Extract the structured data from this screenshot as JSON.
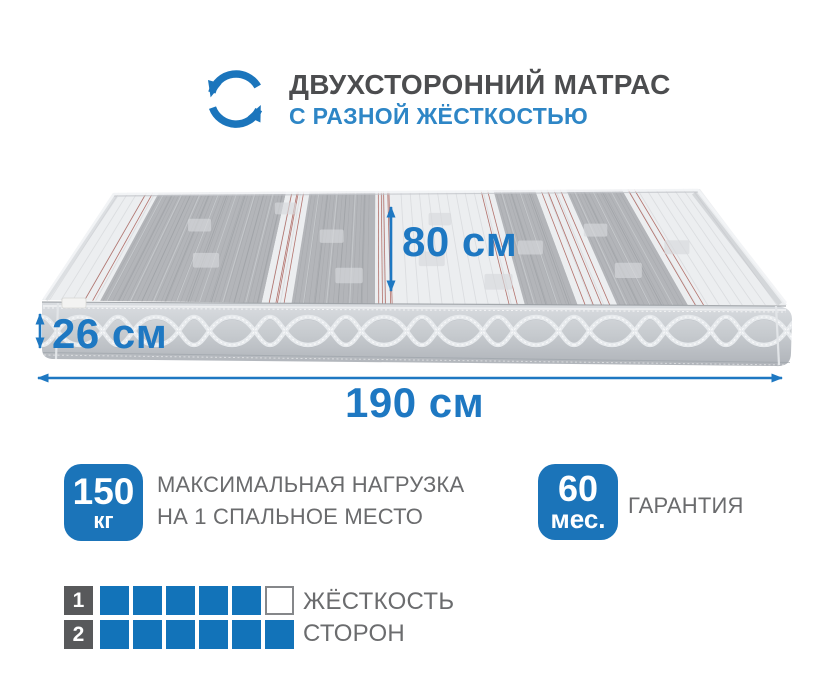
{
  "header": {
    "icon": "rotate-arrows-icon",
    "title": "ДВУХСТОРОННИЙ МАТРАС",
    "subtitle": "С РАЗНОЙ ЖЁСТКОСТЬЮ"
  },
  "dimensions": {
    "depth": "80 см",
    "height": "26 см",
    "length": "190 см"
  },
  "badges": [
    {
      "value": "150",
      "unit": "кг",
      "label_line1": "МАКСИМАЛЬНАЯ НАГРУЗКА",
      "label_line2": "НА 1 СПАЛЬНОЕ МЕСТО"
    },
    {
      "value": "60",
      "unit": "мес.",
      "label_line1": "ГАРАНТИЯ"
    }
  ],
  "firmness": {
    "label_line1": "ЖЁСТКОСТЬ",
    "label_line2": "СТОРОН",
    "scale_max": 6,
    "rows": [
      {
        "number": "1",
        "filled": 5
      },
      {
        "number": "2",
        "filled": 6
      }
    ]
  },
  "colors": {
    "primary_blue": "#1b74b9",
    "square_blue": "#1273b9",
    "arrow_blue": "#1e78c2",
    "subtitle_blue": "#2e86c6",
    "title_gray": "#4c4d4f",
    "label_gray": "#6a6b6d",
    "number_square_gray": "#58595b",
    "empty_square_border": "#85878a"
  }
}
